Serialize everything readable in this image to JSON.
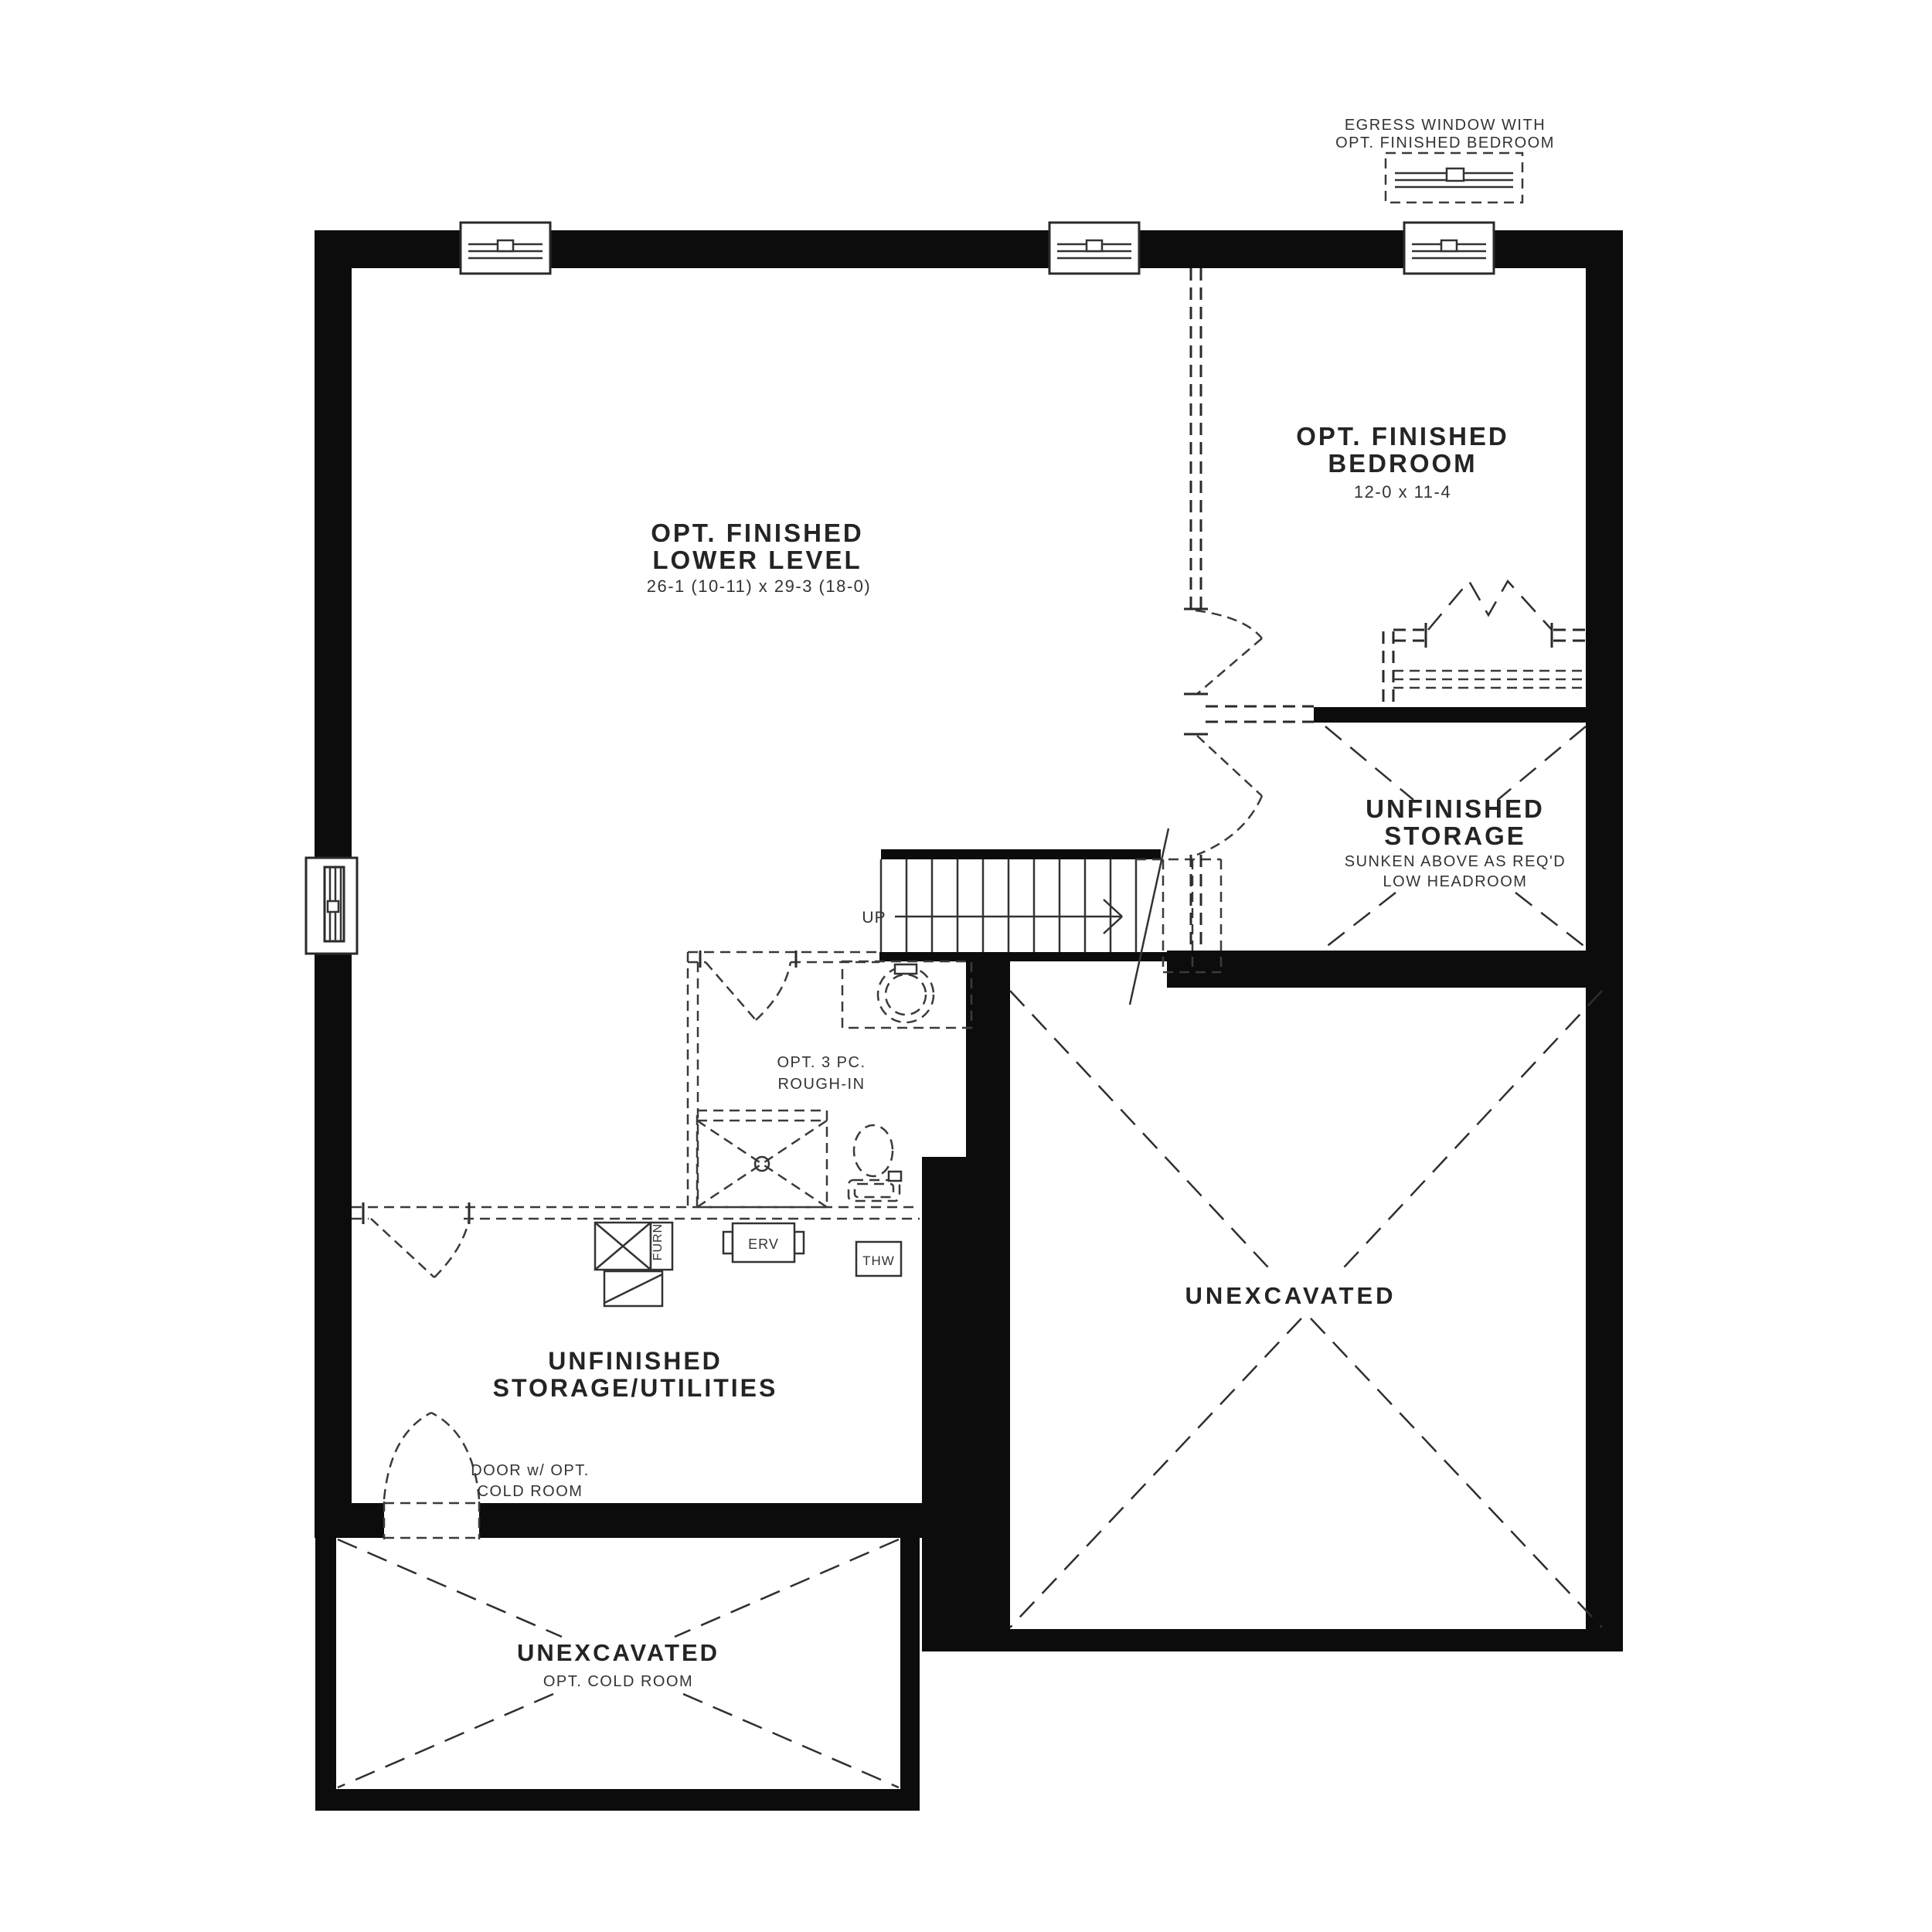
{
  "meta": {
    "colors": {
      "background": "#ffffff",
      "wall": "#0c0c0c",
      "line": "#333333",
      "text": "#2a2a2a"
    }
  },
  "annotations": {
    "egress": {
      "line1": "EGRESS WINDOW WITH",
      "line2": "OPT. FINISHED BEDROOM"
    },
    "door_cold_room": {
      "line1": "DOOR w/ OPT.",
      "line2": "COLD ROOM"
    },
    "up": "UP"
  },
  "rooms": {
    "lower_level": {
      "title1": "OPT. FINISHED",
      "title2": "LOWER LEVEL",
      "dims": "26-1 (10-11) x 29-3 (18-0)"
    },
    "bedroom": {
      "title1": "OPT. FINISHED",
      "title2": "BEDROOM",
      "dims": "12-0 x 11-4"
    },
    "storage": {
      "title1": "UNFINISHED",
      "title2": "STORAGE",
      "note1": "SUNKEN ABOVE AS REQ'D",
      "note2": "LOW HEADROOM"
    },
    "unexcavated_right": {
      "title": "UNEXCAVATED"
    },
    "utilities": {
      "title1": "UNFINISHED",
      "title2": "STORAGE/UTILITIES"
    },
    "cold_room": {
      "title": "UNEXCAVATED",
      "note": "OPT. COLD ROOM"
    },
    "rough_in": {
      "note1": "OPT. 3 PC.",
      "note2": "ROUGH-IN"
    }
  },
  "equipment": {
    "erv": "ERV",
    "thw": "THW",
    "furn": "FURN"
  }
}
